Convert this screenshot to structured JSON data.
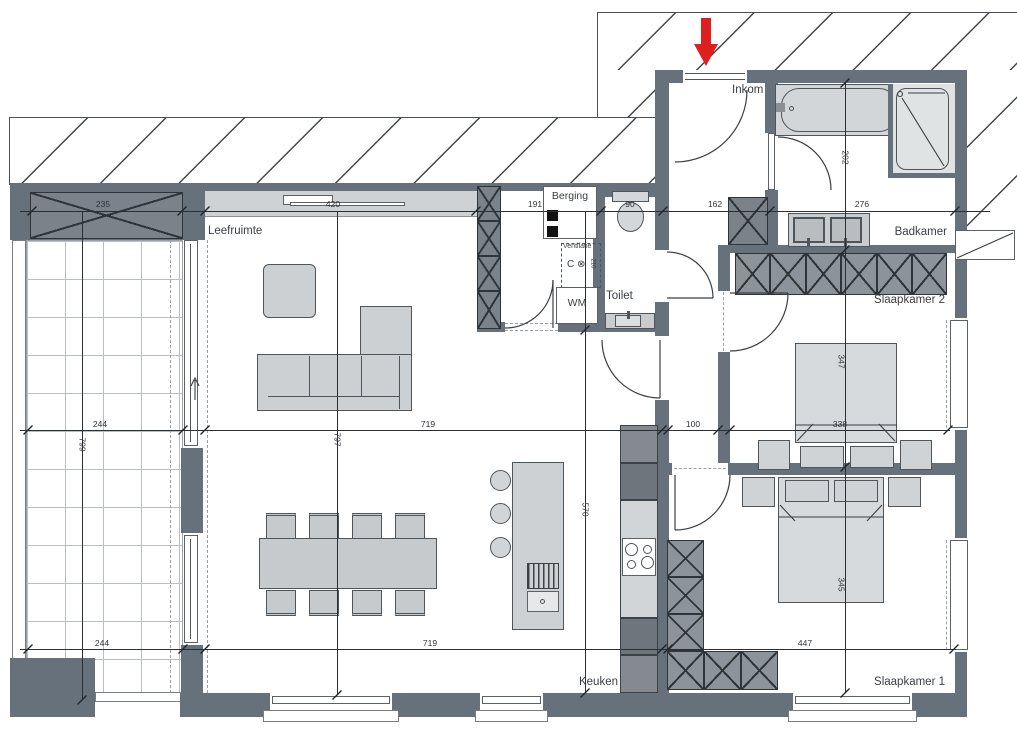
{
  "plan": {
    "rooms": {
      "leefruimte": "Leefruimte",
      "berging": "Berging",
      "ventilatie": "Ventilatie",
      "wm": "WM",
      "toilet": "Toilet",
      "inkom": "Inkom",
      "badkamer": "Badkamer",
      "slaapkamer2": "Slaapkamer 2",
      "slaapkamer1": "Slaapkamer 1",
      "keuken": "Keuken"
    },
    "dims": {
      "terras_breedte_top": "235",
      "leefruimte_top": "420",
      "berging_breedte": "191",
      "toilet_breedte": "90",
      "inkom_breedte": "162",
      "badkamer_breedte": "276",
      "badkamer_hoogte": "202",
      "terras_breedte_mid": "244",
      "terras_hoogte": "799",
      "leefruimte_hoogte": "797",
      "leefruimte_breedte_mid": "719",
      "hal_breedte": "100",
      "slaapkamer2_breedte": "338",
      "slaapkamer2_hoogte": "347",
      "terras_breedte_onder": "244",
      "leefruimte_breedte_onder": "719",
      "keuken_hoogte": "570",
      "slaapkamer1_breedte": "447",
      "slaapkamer1_hoogte": "345"
    },
    "ventilation": {
      "symbol": "C ⊗",
      "size": "210"
    },
    "colors": {
      "wall": "#66717b",
      "arrow": "#de1f1f",
      "furniture": "#cdd1d3",
      "cabinet": "#7b828a"
    }
  }
}
